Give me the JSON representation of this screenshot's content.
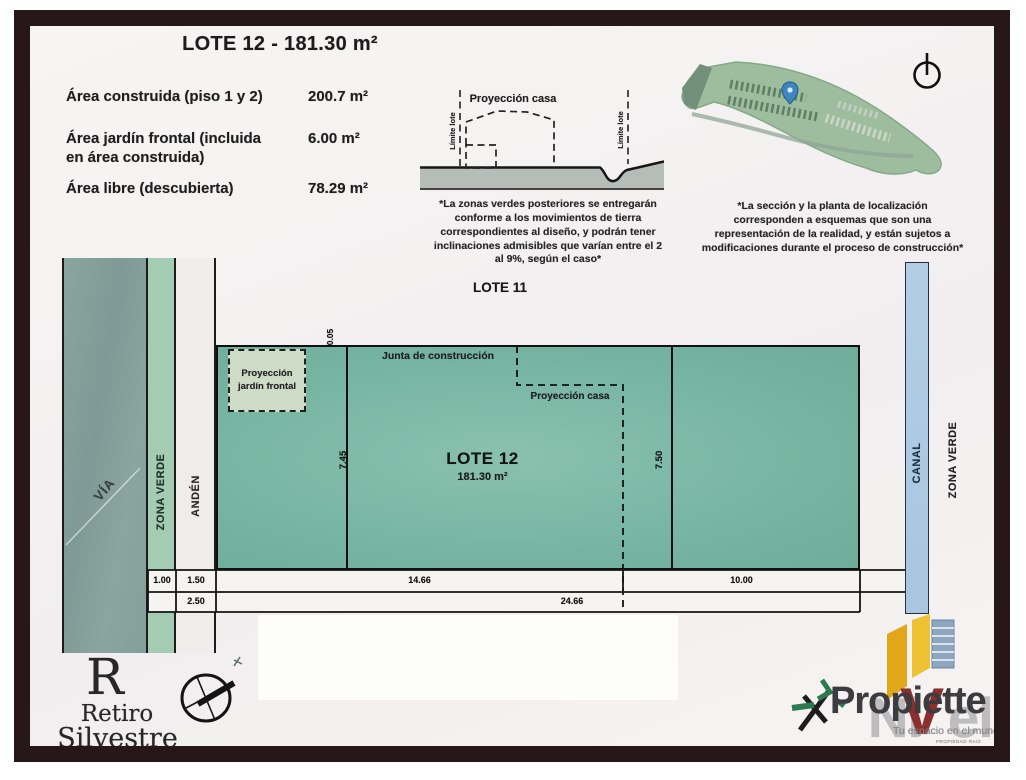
{
  "header": {
    "title": "LOTE 12 - 181.30 m²"
  },
  "areas": {
    "rows": [
      {
        "label": "Área construida (piso 1 y 2)",
        "value": "200.7 m²"
      },
      {
        "label": "Área jardín frontal (incluida\nen área construida)",
        "value": "6.00 m²"
      },
      {
        "label": "Área libre (descubierta)",
        "value": "78.29 m²"
      }
    ]
  },
  "section": {
    "proyeccion_casa": "Proyección casa",
    "limite_lote": "Límite lote",
    "note": "*La zonas verdes posteriores se entregarán\nconforme a los movimientos de tierra\ncorrespondientes al diseño, y podrán tener\ninclinaciones admisibles que varían entre el 2\nal 9%, según el caso*"
  },
  "location": {
    "note": "*La sección y la planta de localización\ncorresponden a esquemas que son una\nrepresentación de la realidad, y están sujetos a\nmodificaciones durante el proceso de construcción*"
  },
  "plan": {
    "lote11": "LOTE 11",
    "lote12_title": "LOTE 12",
    "lote12_area": "181.30 m²",
    "junta": "Junta de construcción",
    "proyeccion_casa": "Proyección casa",
    "proyeccion_jardin": "Proyección\njardín frontal",
    "via": "VÍA",
    "zona_verde": "ZONA VERDE",
    "anden": "ANDÉN",
    "canal": "CANAL",
    "zona_verde_right": "ZONA VERDE",
    "dims": {
      "d005": "0.05",
      "d745": "7.45",
      "d750": "7.50",
      "d100": "1.00",
      "d150": "1.50",
      "d1466": "14.66",
      "d1000": "10.00",
      "d250": "2.50",
      "d2466": "24.66"
    }
  },
  "branding": {
    "retiro": {
      "monogram": "R",
      "line1": "Retiro",
      "line2": "Silvestre",
      "tagline": "EL ESTADO PURO DE LA VIDA"
    },
    "propiette": {
      "name": "Propiette",
      "watermark_pre": "Ni",
      "watermark_v": "V",
      "watermark_post": "el",
      "tagline": "Tu espacio en el mundo",
      "subtext": "PROPIEDAD RAIZ"
    }
  },
  "colors": {
    "frame": "#27161a",
    "lot_fill": "#77b5a2",
    "jardin_fill": "#cedcc7",
    "zona_verde_fill": "#a4ccb3",
    "via_fill": "#87a19c",
    "anden_fill": "#f0ecea",
    "canal_fill": "#aecae3",
    "pin_blue": "#3f86c0",
    "nivel_red": "#8c2f2e",
    "accent_yellow": "#e8b01f",
    "star_green": "#2c7a50"
  }
}
